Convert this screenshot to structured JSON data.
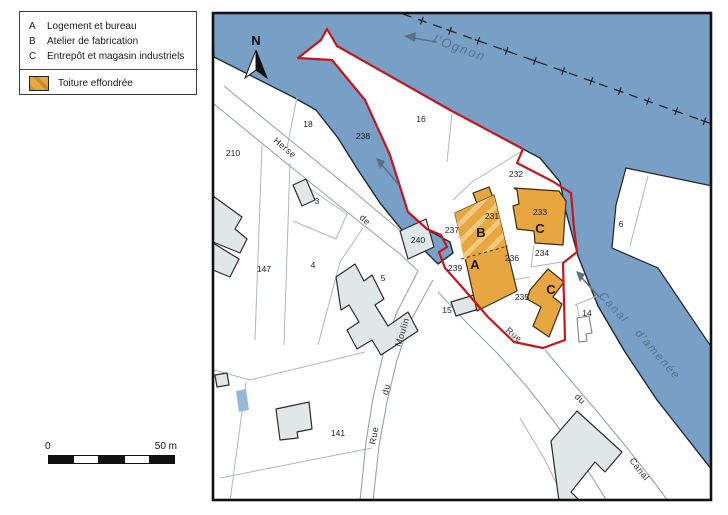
{
  "legend": {
    "items": [
      {
        "key": "A",
        "label": "Logement et bureau"
      },
      {
        "key": "B",
        "label": "Atelier de fabrication"
      },
      {
        "key": "C",
        "label": "Entrepôt et magasin industriels"
      }
    ],
    "swatch_label": "Toiture effondrée"
  },
  "compass": {
    "label": "N"
  },
  "scale_bar": {
    "start_label": "0",
    "end_label": "50 m"
  },
  "water_labels": [
    {
      "text": "l'Ognon",
      "x": 458,
      "y": 52,
      "rot": 20,
      "size": 13
    },
    {
      "text": "Canal",
      "x": 611,
      "y": 310,
      "rot": 47,
      "size": 11.5
    },
    {
      "text": "d'amenée",
      "x": 655,
      "y": 357,
      "rot": 49,
      "size": 11.5
    }
  ],
  "street_labels": [
    {
      "text": "Herse",
      "x": 283,
      "y": 150,
      "rot": 40
    },
    {
      "text": "de",
      "x": 363,
      "y": 222,
      "rot": 43
    },
    {
      "text": "Rue",
      "x": 512,
      "y": 337,
      "rot": 40
    },
    {
      "text": "du",
      "x": 578,
      "y": 401,
      "rot": 45
    },
    {
      "text": "Canal",
      "x": 637,
      "y": 471,
      "rot": 52
    },
    {
      "text": "Rue",
      "x": 377,
      "y": 436,
      "rot": -80
    },
    {
      "text": "du",
      "x": 389,
      "y": 390,
      "rot": -77
    },
    {
      "text": "Moulin",
      "x": 405,
      "y": 333,
      "rot": -73
    }
  ],
  "parcel_labels": [
    {
      "text": "210",
      "x": 233,
      "y": 156
    },
    {
      "text": "18",
      "x": 308,
      "y": 127
    },
    {
      "text": "16",
      "x": 421,
      "y": 122
    },
    {
      "text": "238",
      "x": 363,
      "y": 139
    },
    {
      "text": "232",
      "x": 516,
      "y": 177
    },
    {
      "text": "231",
      "x": 492,
      "y": 219
    },
    {
      "text": "233",
      "x": 540,
      "y": 215
    },
    {
      "text": "237",
      "x": 452,
      "y": 233
    },
    {
      "text": "240",
      "x": 418,
      "y": 243
    },
    {
      "text": "3",
      "x": 317,
      "y": 204
    },
    {
      "text": "4",
      "x": 313,
      "y": 268
    },
    {
      "text": "5",
      "x": 383,
      "y": 281
    },
    {
      "text": "147",
      "x": 264,
      "y": 272
    },
    {
      "text": "239",
      "x": 455,
      "y": 271
    },
    {
      "text": "236",
      "x": 512,
      "y": 261
    },
    {
      "text": "234",
      "x": 542,
      "y": 256
    },
    {
      "text": "235",
      "x": 522,
      "y": 300
    },
    {
      "text": "6",
      "x": 621,
      "y": 227
    },
    {
      "text": "14",
      "x": 587,
      "y": 316
    },
    {
      "text": "15",
      "x": 447,
      "y": 313
    },
    {
      "text": "141",
      "x": 338,
      "y": 436
    }
  ],
  "building_labels": [
    {
      "text": "A",
      "x": 475,
      "y": 269
    },
    {
      "text": "B",
      "x": 481,
      "y": 237
    },
    {
      "text": "C",
      "x": 540,
      "y": 233
    },
    {
      "text": "C",
      "x": 551,
      "y": 294
    }
  ],
  "colors": {
    "water": "#78a0c6",
    "collapsed_roof_orange": "#e7a63f",
    "roof_hatch_light": "#f3c97e",
    "building_gray": "#dfe7e7",
    "site_boundary_red": "#c4161c",
    "water_label_blue": "#54738e",
    "pool_blue": "#96b8d8"
  }
}
